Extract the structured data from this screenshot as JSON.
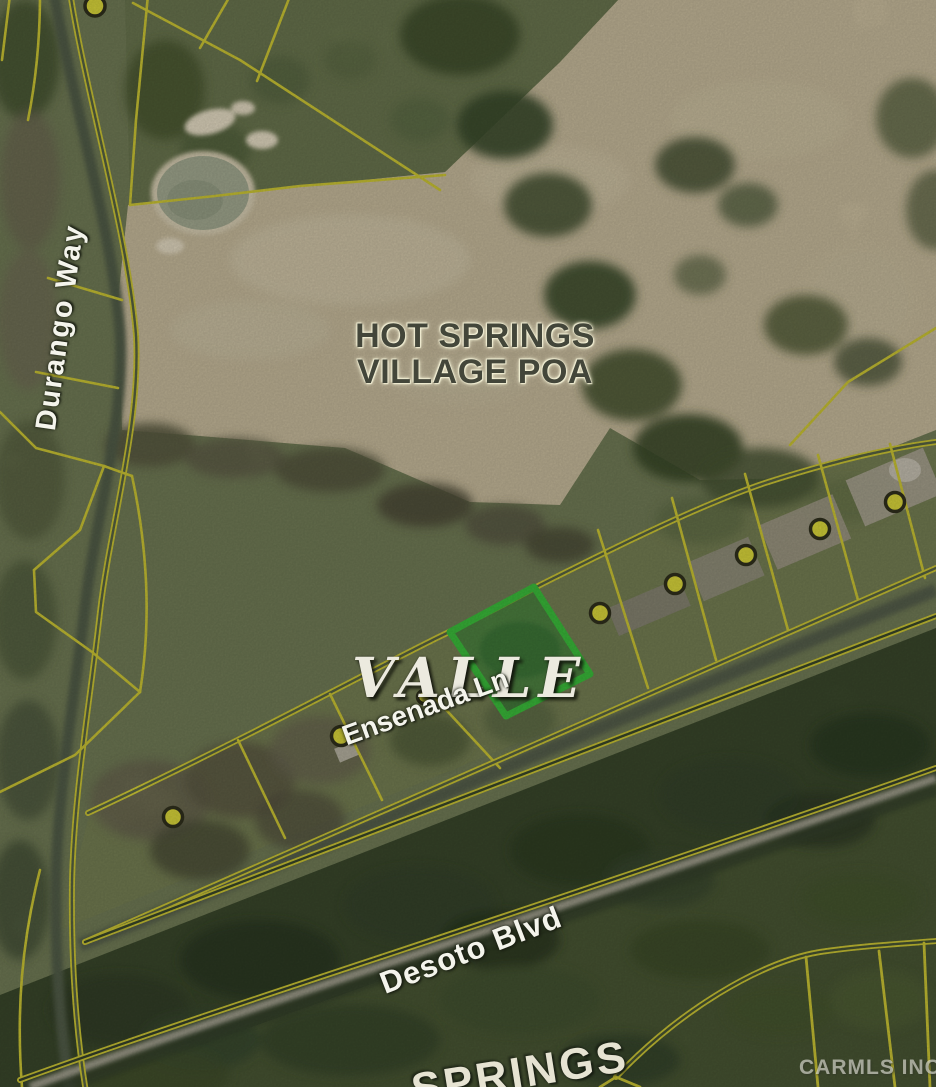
{
  "map": {
    "type": "aerial-parcel-map",
    "region_label": {
      "line1": "HOT SPRINGS",
      "line2": "VILLAGE POA"
    },
    "subdivision_label": "VALLE",
    "streets": {
      "durango": "Durango Way",
      "ensenada": "Ensenada Ln",
      "desoto": "Desoto Blvd"
    },
    "partial_bottom_label": "SPRINGS",
    "watermark": "CARMLS INC",
    "highlighted_parcel": {
      "border_color": "#3ec63e",
      "fill_color": "rgba(40,140,50,0.5)"
    },
    "parcel_line_color": "#d6d038",
    "parcel_markers": {
      "color": "#e6e23e",
      "count": 9
    }
  }
}
